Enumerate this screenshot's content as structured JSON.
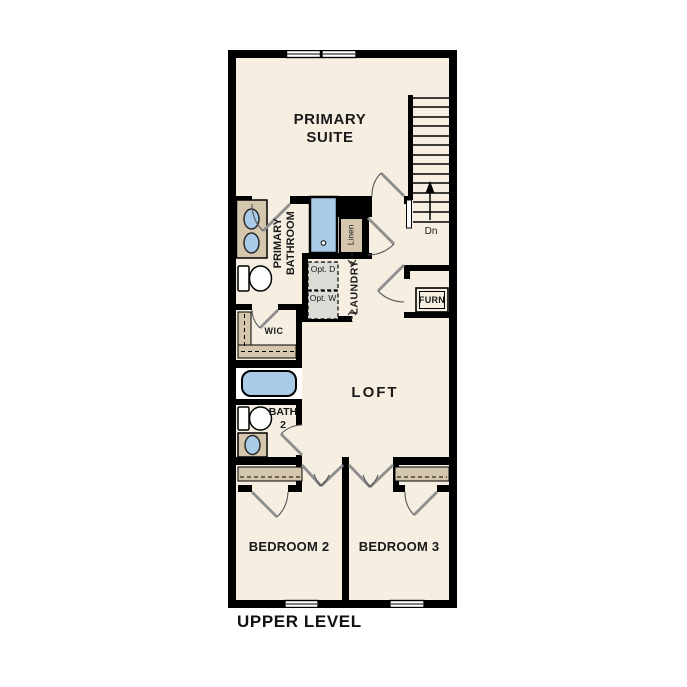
{
  "plan": {
    "level_label": "UPPER LEVEL",
    "rooms": {
      "primary_suite": "PRIMARY SUITE",
      "primary_bathroom": "PRIMARY BATHROOM",
      "wic": "WIC",
      "linen": "Linen",
      "laundry": "LAUNDRY",
      "loft": "LOFT",
      "bath2": "BATH 2",
      "bedroom2": "BEDROOM 2",
      "bedroom3": "BEDROOM 3"
    },
    "features": {
      "furnace": "FURN",
      "optional_dryer": "Opt. D",
      "optional_washer": "Opt. W",
      "stairs_direction": "Dn"
    },
    "colors": {
      "floor": "#f5eee1",
      "wall": "#000000",
      "fixture_blue": "#a9cbe7",
      "fixture_tan": "#d4c7ae",
      "optional_gray": "#dcdcd7"
    }
  }
}
